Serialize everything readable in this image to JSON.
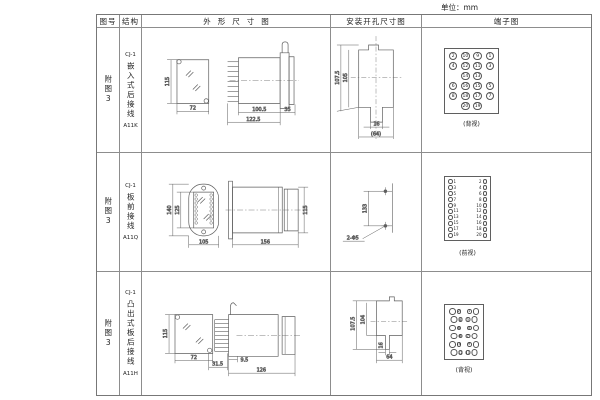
{
  "unit_label": "单位：mm",
  "headers": {
    "fig": "图号",
    "structure": "结构",
    "outline": "外形尺寸图",
    "mounting": "安装开孔尺寸图",
    "terminal": "端子图"
  },
  "rows": [
    {
      "fig_no": "附图3",
      "model": "CJ-1",
      "structure_desc": "嵌入式后接线",
      "code": "A11K",
      "dims": {
        "front_h": "115",
        "front_w": "72",
        "body": "100.5",
        "overall": "122.5",
        "flange": "35"
      },
      "mount": {
        "d1": "107.5",
        "d2": "105",
        "d3": "16",
        "d4": "(64)"
      },
      "terminal": {
        "type": "grid",
        "caption": "(背视)",
        "grid": [
          [
            "2",
            "10",
            "9",
            "1"
          ],
          [
            "4",
            "12",
            "11",
            "3"
          ],
          [
            "",
            "14",
            "13",
            ""
          ],
          [
            "6",
            "16",
            "15",
            "5"
          ],
          [
            "8",
            "18",
            "17",
            "7"
          ],
          [
            "",
            "20",
            "19",
            ""
          ]
        ]
      }
    },
    {
      "fig_no": "附图3",
      "model": "CJ-1",
      "structure_desc": "板前接线",
      "code": "A11Q",
      "dims": {
        "front_h": "140",
        "inner_h": "125",
        "front_w": "105",
        "body": "156",
        "side_h": "115"
      },
      "mount": {
        "d1": "133",
        "d2": "2-Φ5"
      },
      "terminal": {
        "type": "columns",
        "caption": "(前视)",
        "left": [
          "1",
          "3",
          "5",
          "7",
          "9",
          "11",
          "13",
          "15",
          "17",
          "19"
        ],
        "right": [
          "2",
          "4",
          "6",
          "8",
          "10",
          "12",
          "14",
          "16",
          "18",
          "20"
        ]
      }
    },
    {
      "fig_no": "附图3",
      "model": "CJ-1",
      "structure_desc": "凸出式板后接线",
      "code": "A11H",
      "dims": {
        "front_h": "115",
        "front_w": "72",
        "pin": "9.5",
        "comb": "31.5",
        "body": "126"
      },
      "mount": {
        "d1": "107.5",
        "d2": "104",
        "d3": "16",
        "d4": "64"
      },
      "terminal": {
        "type": "pairs",
        "caption": "(背视)",
        "left": [
          "2",
          "4",
          "6",
          "8",
          "10",
          "12"
        ],
        "right": [
          "1",
          "3",
          "5",
          "7",
          "9",
          "11"
        ]
      }
    }
  ]
}
